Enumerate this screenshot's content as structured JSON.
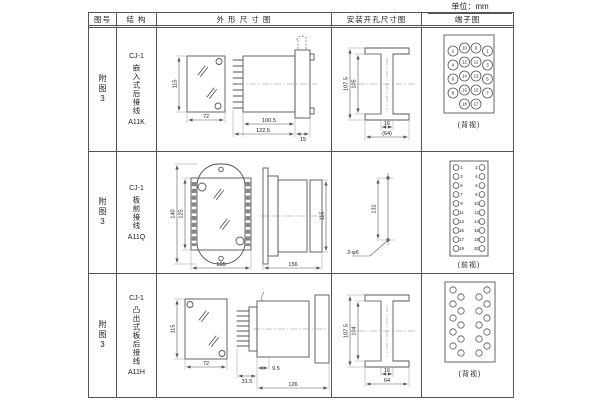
{
  "unit_label": "单位：mm",
  "header": {
    "fig": "图号",
    "structure": "结 构",
    "outline": "外 形 尺 寸 图",
    "mounting": "安装开孔尺寸图",
    "terminal": "端子图"
  },
  "rows": [
    {
      "fig": "附图3",
      "model": "CJ-1",
      "structure": "嵌入式后接线",
      "code": "A11K",
      "outline": {
        "front_height": "115",
        "front_width": "72",
        "body_depth": "100.5",
        "total_depth": "122.5",
        "flange_depth": "15"
      },
      "mounting": {
        "outer_height": "107.5",
        "inner_height": "105",
        "slot_width": "16",
        "overall_width": "(64)"
      },
      "terminal": {
        "caption": "(背视)",
        "rows": [
          [
            "2",
            "10",
            "9",
            "1"
          ],
          [
            "4",
            "12",
            "11",
            "3"
          ],
          [
            "6",
            "14",
            "13",
            "5"
          ],
          [
            "8",
            "16",
            "15",
            "7"
          ],
          [
            "18",
            "17"
          ]
        ]
      }
    },
    {
      "fig": "附图3",
      "model": "CJ-1",
      "structure": "板前接线",
      "code": "A11Q",
      "outline": {
        "outer_height": "140",
        "inner_height": "125",
        "front_width": "105",
        "total_depth": "156",
        "side_height": "115"
      },
      "mounting": {
        "hole_spacing": "131",
        "hole_label": "2-φ6"
      },
      "terminal": {
        "caption": "(前视)",
        "left_numbers": [
          "1",
          "3",
          "5",
          "7",
          "9",
          "11",
          "13",
          "15",
          "17",
          "19"
        ],
        "right_numbers": [
          "2",
          "4",
          "6",
          "8",
          "10",
          "12",
          "14",
          "16",
          "18",
          "20"
        ]
      }
    },
    {
      "fig": "附图3",
      "model": "CJ-1",
      "structure": "凸出式板后接线",
      "code": "A11H",
      "outline": {
        "front_height": "115",
        "front_width": "72",
        "pin_depth": "31.5",
        "step_depth": "9.5",
        "body_depth": "126"
      },
      "mounting": {
        "outer_height": "107.5",
        "inner_height": "104",
        "slot_width": "16",
        "overall_width": "64"
      },
      "terminal": {
        "caption": "(背视)"
      }
    }
  ]
}
